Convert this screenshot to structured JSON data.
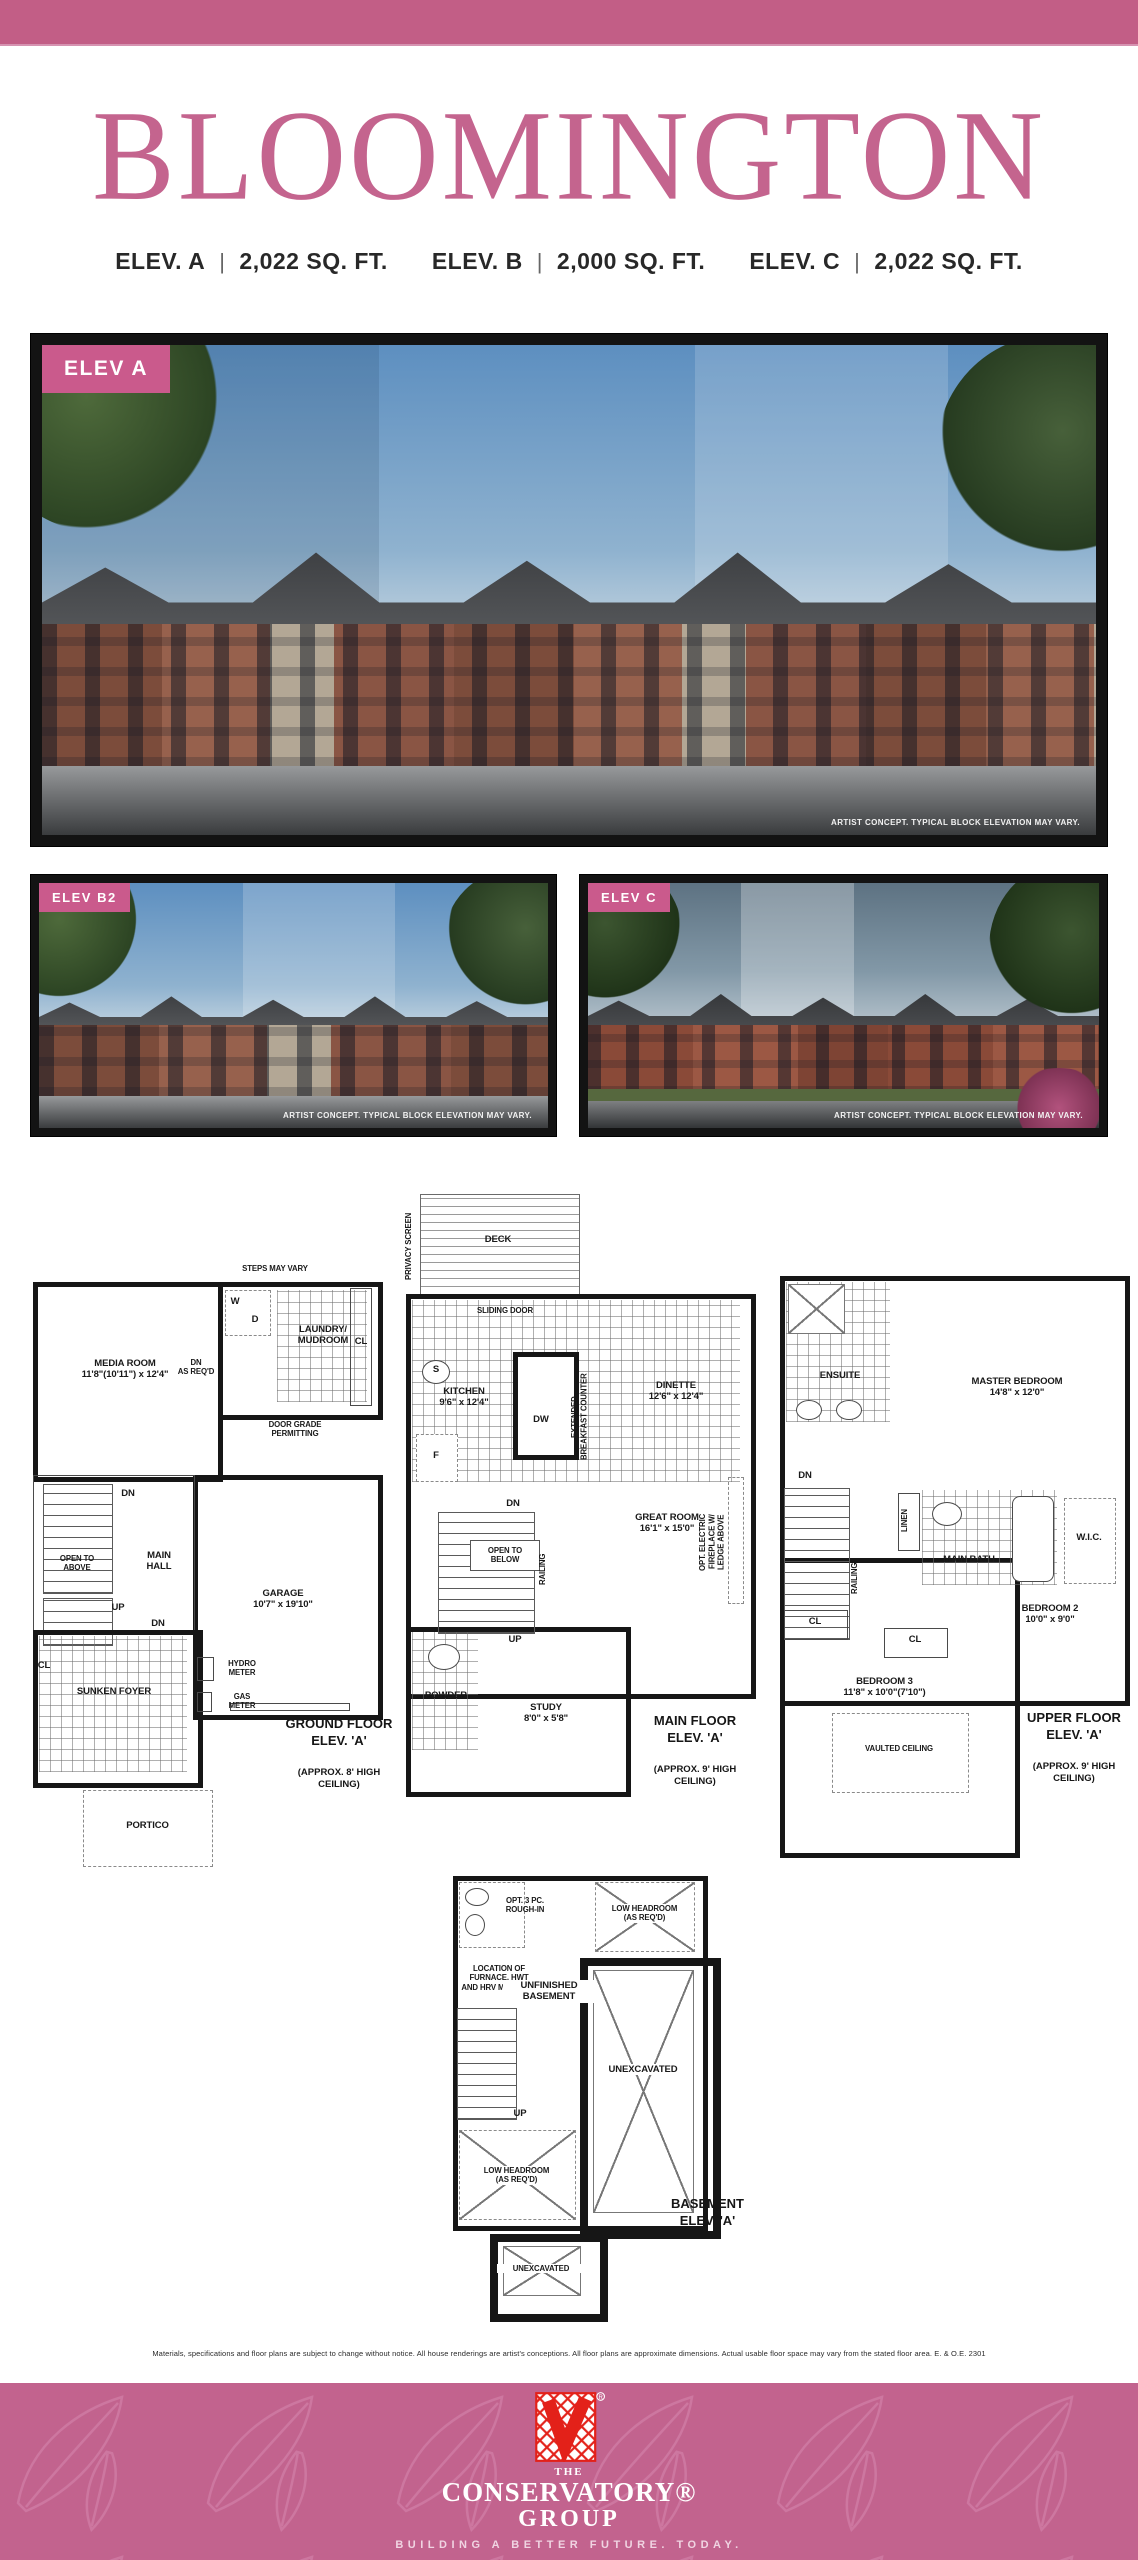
{
  "colors": {
    "pink_bar": "#c25e86",
    "title_pink": "#c4648e",
    "badge_pink": "#ca5a8c",
    "footer_pink": "#c2638e",
    "logo_red": "#e32119"
  },
  "header": {
    "title": "BLOOMINGTON"
  },
  "specs": {
    "divider": "|",
    "items": [
      {
        "elev": "ELEV. A",
        "sqft": "2,022 SQ. FT."
      },
      {
        "elev": "ELEV. B",
        "sqft": "2,000 SQ. FT."
      },
      {
        "elev": "ELEV. C",
        "sqft": "2,022 SQ. FT."
      }
    ]
  },
  "renderings": {
    "caption": "ARTIST CONCEPT. TYPICAL BLOCK ELEVATION MAY VARY.",
    "main_label": "ELEV A",
    "left_label": "ELEV B2",
    "right_label": "ELEV C"
  },
  "floorplans": {
    "ground": {
      "title": "GROUND FLOOR\nELEV. 'A'",
      "subtitle": "(APPROX. 8' HIGH\nCEILING)",
      "labels": {
        "steps": "STEPS MAY VARY",
        "w": "W",
        "d": "D",
        "laundry": "LAUNDRY/\nMUDROOM",
        "cl1": "CL",
        "media_room": "MEDIA ROOM\n11'8\"(10'11\") x 12'4\"",
        "dn_as_reqd": "DN\nAS REQ'D",
        "door_grade": "DOOR GRADE\nPERMITTING",
        "dn1": "DN",
        "open_above": "OPEN TO\nABOVE",
        "main_hall": "MAIN\nHALL",
        "garage": "GARAGE\n10'7\" x 19'10\"",
        "up": "UP",
        "dn2": "DN",
        "cl2": "CL",
        "foyer": "SUNKEN FOYER",
        "hydro": "HYDRO\nMETER",
        "gas": "GAS\nMETER",
        "portico": "PORTICO"
      }
    },
    "main": {
      "title": "MAIN FLOOR\nELEV. 'A'",
      "subtitle": "(APPROX. 9' HIGH\nCEILING)",
      "labels": {
        "privacy": "PRIVACY SCREEN",
        "deck": "DECK",
        "sliding": "SLIDING DOOR",
        "s": "S",
        "kitchen": "KITCHEN\n9'6\" x 12'4\"",
        "dw": "DW",
        "counter": "EXTENDED\nBREAKFAST COUNTER",
        "f": "F",
        "dinette": "DINETTE\n12'6\" x 12'4\"",
        "dn": "DN",
        "open_below": "OPEN TO\nBELOW",
        "railing": "RAILING",
        "up": "UP",
        "great_room": "GREAT ROOM\n16'1\" x 15'0\"",
        "fireplace": "OPT. ELECTRIC\nFIREPLACE W/\nLEDGE ABOVE",
        "powder": "POWDER",
        "study": "STUDY\n8'0\" x 5'8\""
      }
    },
    "upper": {
      "title": "UPPER FLOOR\nELEV. 'A'",
      "subtitle": "(APPROX. 9' HIGH\nCEILING)",
      "labels": {
        "ensuite": "ENSUITE",
        "master": "MASTER BEDROOM\n14'8\" x 12'0\"",
        "dn": "DN",
        "railing": "RAILING",
        "linen": "LINEN",
        "main_bath": "MAIN BATH",
        "wic": "W.I.C.",
        "cl1": "CL",
        "cl2": "CL",
        "bedroom2": "BEDROOM 2\n10'0\" x 9'0\"",
        "bedroom3": "BEDROOM 3\n11'8\" x 10'0\"(7'10\")",
        "vaulted": "VAULTED CEILING"
      }
    },
    "basement": {
      "title": "BASEMENT\nELEV. 'A'",
      "labels": {
        "rough_in": "OPT. 3 PC.\nROUGH-IN",
        "low_head1": "LOW HEADROOM\n(AS REQ'D)",
        "furnace": "LOCATION OF\nFURNACE, HWT\nAND HRV MAY VARY",
        "unfinished": "UNFINISHED\nBASEMENT",
        "up": "UP",
        "unexcavated1": "UNEXCAVATED",
        "low_head2": "LOW HEADROOM\n(AS REQ'D)",
        "unexcavated2": "UNEXCAVATED"
      }
    }
  },
  "disclaimer": "Materials, specifications and floor plans are subject to change without notice. All house renderings are artist's conceptions. All floor plans are approximate dimensions. Actual usable floor space may vary from the stated floor area. E. & O.E. 2301",
  "footer": {
    "the": "THE",
    "name": "CONSERVATORY®",
    "group": "GROUP",
    "tagline": "BUILDING A BETTER FUTURE. TODAY."
  }
}
